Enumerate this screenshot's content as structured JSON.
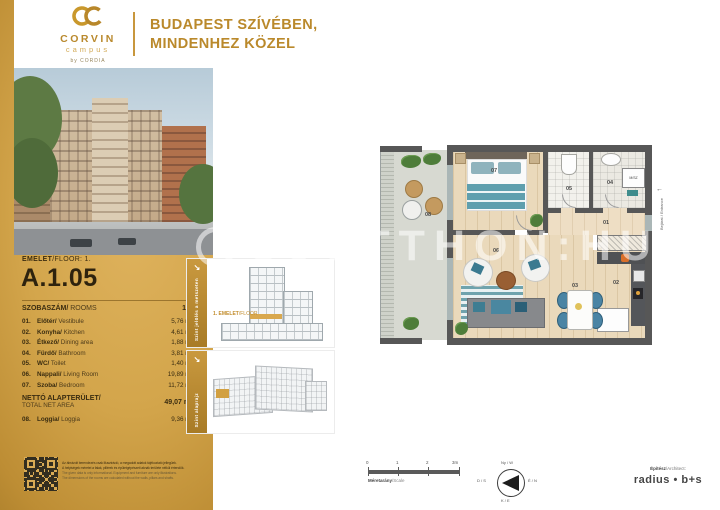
{
  "colors": {
    "gold": "#c8973d",
    "gold_dark": "#946c1e",
    "wall_gray": "#575757",
    "teal": "#3e7d92",
    "text_dark": "#2e230e"
  },
  "header": {
    "logo": {
      "name": "CORVIN",
      "sub": "campus",
      "by": "by CORDIA"
    },
    "headline": {
      "line1": "BUDAPEST SZÍVÉBEN,",
      "line2": "MINDENHEZ KÖZEL"
    }
  },
  "left_panel": {
    "floor_label_hu": "EMELET",
    "floor_label_en": "/FLOOR: 1.",
    "unit_code": "A.1.05",
    "rooms_header_hu": "SZOBASZÁM/",
    "rooms_header_en": "ROOMS",
    "rooms_value": "1+1",
    "rooms": [
      {
        "num": "01.",
        "hu": "Előtér/",
        "en": "Vestibule",
        "area": "5,76 m2"
      },
      {
        "num": "02.",
        "hu": "Konyha/",
        "en": "Kitchen",
        "area": "4,61 m2"
      },
      {
        "num": "03.",
        "hu": "Étkező/",
        "en": "Dining area",
        "area": "1,88 m2"
      },
      {
        "num": "04.",
        "hu": "Fürdő/",
        "en": "Bathroom",
        "area": "3,81 m2"
      },
      {
        "num": "05.",
        "hu": "WC/",
        "en": "Toilet",
        "area": "1,40 m2"
      },
      {
        "num": "06.",
        "hu": "Nappali/",
        "en": "Living Room",
        "area": "19,89 m2"
      },
      {
        "num": "07.",
        "hu": "Szoba/",
        "en": "Bedroom",
        "area": "11,72 m2"
      }
    ],
    "total_hu": "NETTÓ ALAPTERÜLET/",
    "total_en": "TOTAL NET AREA",
    "total_value": "49,07 m2",
    "loggia": {
      "num": "08.",
      "hu": "Loggia/",
      "en": "Loggia",
      "area": "9,36 m2"
    },
    "disclaimer": {
      "hu1": "Az ábrázolt berendezés csak illusztráció, a megadott adatok tájékoztató jellegűek.",
      "hu2": "A helyiségek méretei a falak, pillérek és épületgépészeti aknák területe nélkül értendők.",
      "en1": "The given data is only informational. Equipment and furniture are only illustrations.",
      "en2": "The dimensions of the rooms are calculated without the walls, pillars and shafts."
    }
  },
  "thumbnails": {
    "section": {
      "strip_label": "Szint jelölés a metszeten",
      "caption_hu": "1. EMELET",
      "caption_en": "/FLOOR"
    },
    "keyplan": {
      "strip_label": "Szint alaprajz"
    }
  },
  "plan": {
    "labels": {
      "n01": "01",
      "n02": "02",
      "n03": "03",
      "n04": "04",
      "n05": "05",
      "n06": "06",
      "n07": "07",
      "n08": "08"
    },
    "washer_label": "M/SZ",
    "entrance_label": "Bejárat / Entrance"
  },
  "watermark": {
    "text": "UJOTTHON:HU"
  },
  "footer": {
    "scale": {
      "t0": "0",
      "t1": "1",
      "t2": "2",
      "t3": "3m",
      "label_hu": "Méretarány",
      "label_en": "/Scale"
    },
    "compass": {
      "top": "Ny / W",
      "left": "D / S",
      "right": "É / N",
      "bottom": "K / E"
    },
    "architect": {
      "label_hu": "Építész",
      "label_en": "/Architect:",
      "name": "radius • b+s"
    }
  },
  "icons": {
    "strip_arrow": "↘",
    "entrance_arrow": "←"
  }
}
